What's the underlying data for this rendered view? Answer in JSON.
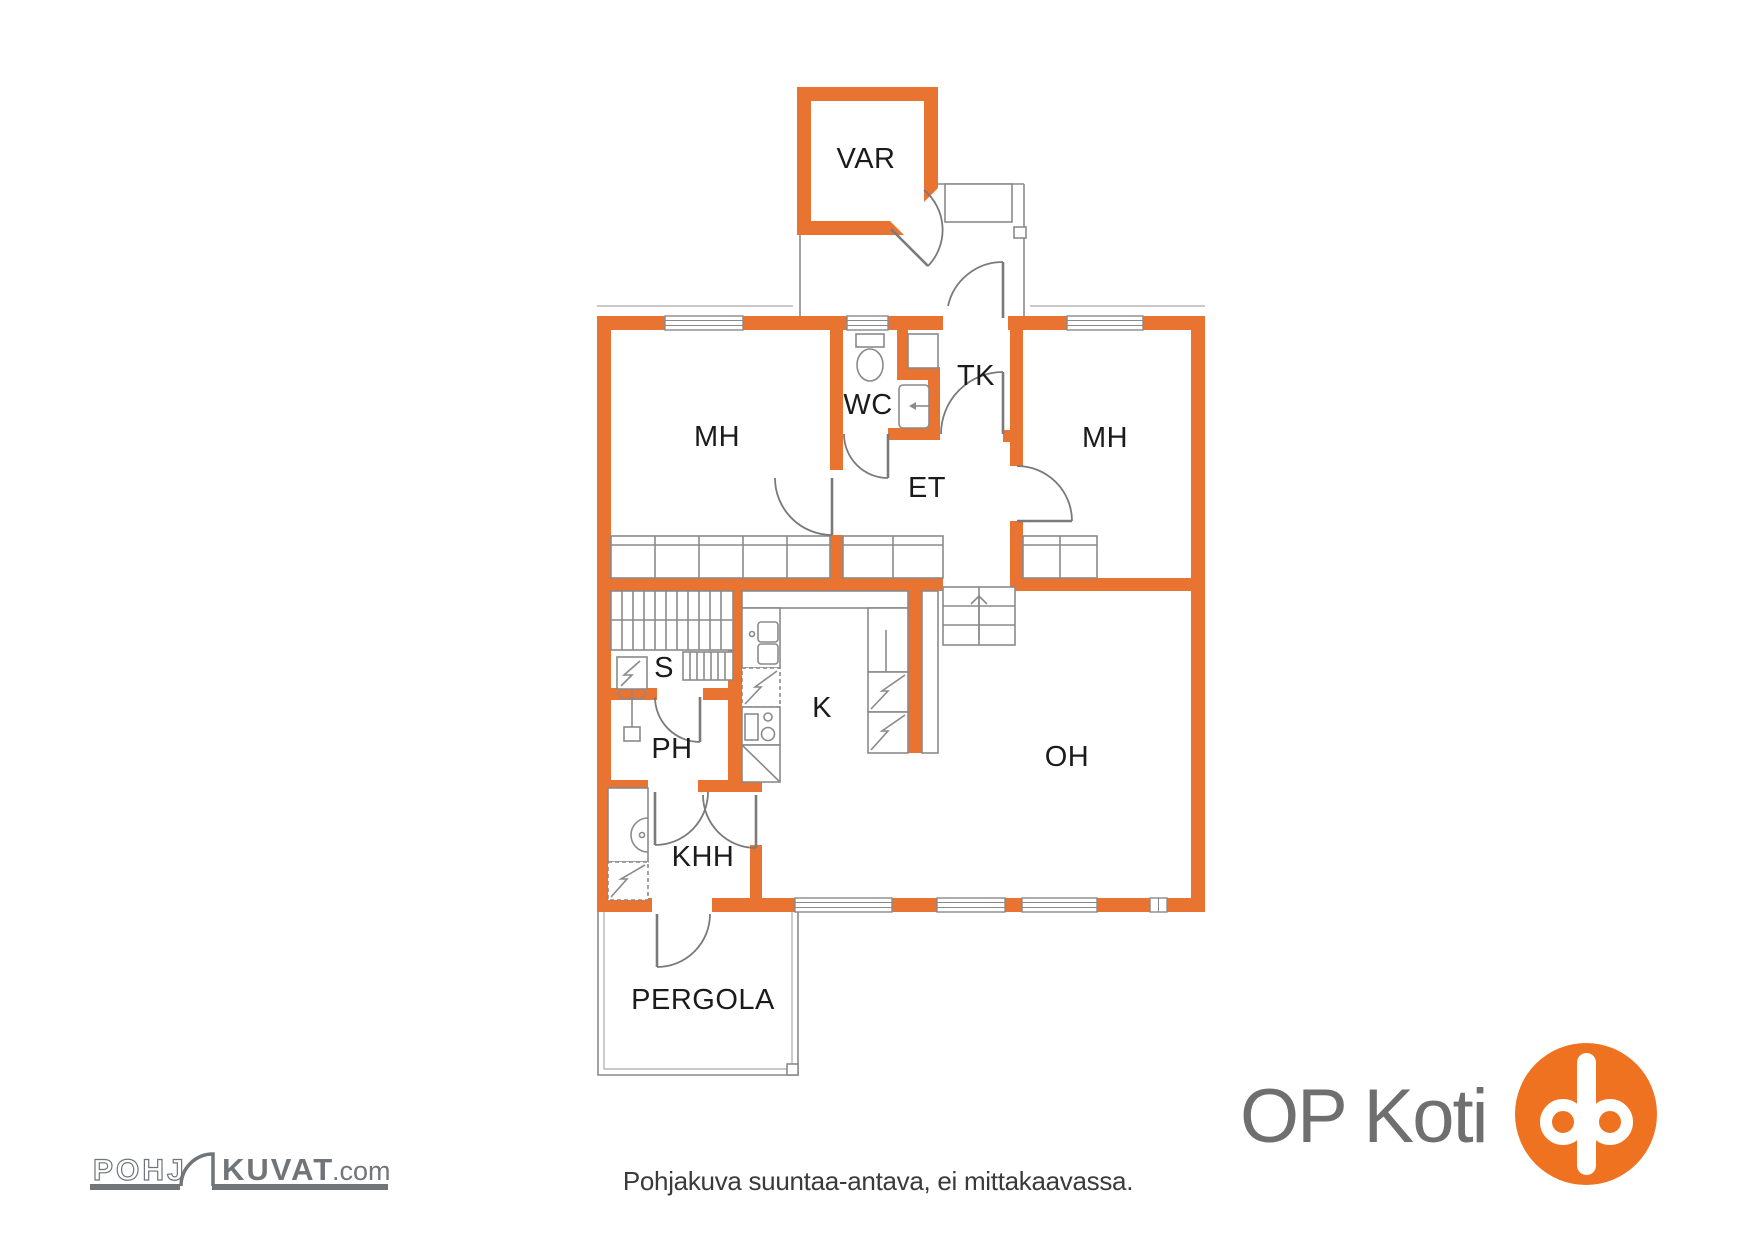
{
  "rooms": {
    "var": {
      "label": "VAR"
    },
    "mh_left": {
      "label": "MH"
    },
    "wc": {
      "label": "WC"
    },
    "tk": {
      "label": "TK"
    },
    "et": {
      "label": "ET"
    },
    "mh_right": {
      "label": "MH"
    },
    "s": {
      "label": "S"
    },
    "ph": {
      "label": "PH"
    },
    "k": {
      "label": "K"
    },
    "oh": {
      "label": "OH"
    },
    "khh": {
      "label": "KHH"
    },
    "pergola": {
      "label": "PERGOLA"
    }
  },
  "footer": {
    "note": "Pohjakuva suuntaa-antava, ei mittakaavassa."
  },
  "branding": {
    "op_koti": {
      "text": "OP Koti"
    },
    "pohjakuvat": {
      "prefix": "POHJ",
      "main": "KUVAT",
      "suffix": ".com"
    }
  },
  "colors": {
    "wall_orange": "#E97330",
    "brand_orange": "#EE7220",
    "line_gray": "#8A8A8A",
    "label_dark": "#1B1B1B",
    "logo_gray": "#6F6F6F"
  }
}
